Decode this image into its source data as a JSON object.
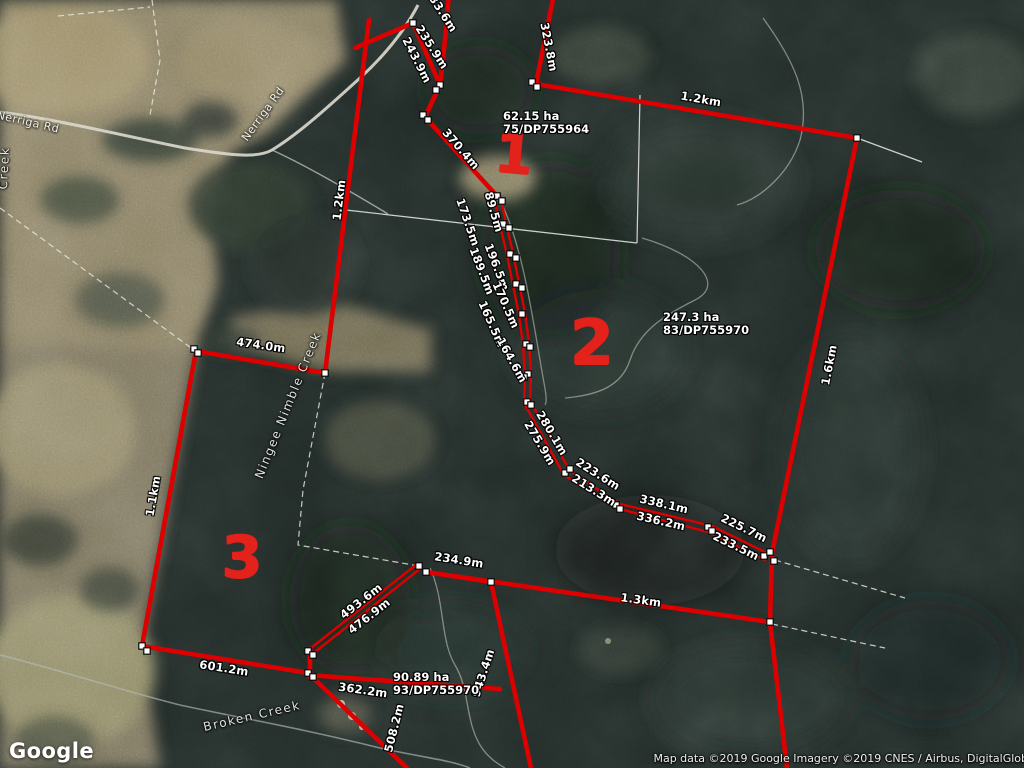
{
  "colors": {
    "boundary_red": "#dc0000",
    "marker_red": "#e3221c",
    "vertex_fill": "#ffffff",
    "vertex_stroke": "#0b0b0b"
  },
  "map": {
    "logo": "Google",
    "attribution": "Map data ©2019 Google  Imagery ©2019 CNES / Airbus, DigitalGlob",
    "measurements": [
      {
        "text": "233.6m",
        "x": 441,
        "y": 10,
        "rot": 57
      },
      {
        "text": "235.9m",
        "x": 432,
        "y": 47,
        "rot": 57
      },
      {
        "text": "243.9m",
        "x": 417,
        "y": 60,
        "rot": 63
      },
      {
        "text": "370.4m",
        "x": 461,
        "y": 149,
        "rot": 49
      },
      {
        "text": "323.8m",
        "x": 549,
        "y": 47,
        "rot": 79
      },
      {
        "text": "1.2km",
        "x": 701,
        "y": 99,
        "rot": 10
      },
      {
        "text": "1.6km",
        "x": 829,
        "y": 365,
        "rot": -79
      },
      {
        "text": "1.2km",
        "x": 339,
        "y": 200,
        "rot": -83
      },
      {
        "text": "173.5m",
        "x": 468,
        "y": 222,
        "rot": 71
      },
      {
        "text": "89.5m",
        "x": 494,
        "y": 212,
        "rot": 74
      },
      {
        "text": "196.5m",
        "x": 497,
        "y": 267,
        "rot": 69
      },
      {
        "text": "189.5m",
        "x": 482,
        "y": 271,
        "rot": 69
      },
      {
        "text": "170.5m",
        "x": 506,
        "y": 305,
        "rot": 66
      },
      {
        "text": "165.5m",
        "x": 492,
        "y": 324,
        "rot": 66
      },
      {
        "text": "164.6m",
        "x": 512,
        "y": 360,
        "rot": 61
      },
      {
        "text": "280.1m",
        "x": 552,
        "y": 433,
        "rot": 59
      },
      {
        "text": "275.9m",
        "x": 540,
        "y": 443,
        "rot": 59
      },
      {
        "text": "223.6m",
        "x": 598,
        "y": 474,
        "rot": 32
      },
      {
        "text": "213.3m",
        "x": 594,
        "y": 490,
        "rot": 32
      },
      {
        "text": "338.1m",
        "x": 664,
        "y": 504,
        "rot": 13
      },
      {
        "text": "336.2m",
        "x": 661,
        "y": 521,
        "rot": 13
      },
      {
        "text": "225.7m",
        "x": 744,
        "y": 528,
        "rot": 26
      },
      {
        "text": "233.5m",
        "x": 736,
        "y": 546,
        "rot": 26
      },
      {
        "text": "474.0m",
        "x": 261,
        "y": 345,
        "rot": 8
      },
      {
        "text": "1.1km",
        "x": 153,
        "y": 496,
        "rot": -80
      },
      {
        "text": "234.9m",
        "x": 459,
        "y": 560,
        "rot": 9
      },
      {
        "text": "1.3km",
        "x": 641,
        "y": 600,
        "rot": 8
      },
      {
        "text": "493.6m",
        "x": 361,
        "y": 601,
        "rot": -38
      },
      {
        "text": "476.9m",
        "x": 369,
        "y": 616,
        "rot": -38
      },
      {
        "text": "601.2m",
        "x": 224,
        "y": 668,
        "rot": 9
      },
      {
        "text": "362.2m",
        "x": 363,
        "y": 690,
        "rot": 8
      },
      {
        "text": "508.2m",
        "x": 394,
        "y": 728,
        "rot": -76
      },
      {
        "text": "943.4m",
        "x": 483,
        "y": 673,
        "rot": -72
      }
    ],
    "parcel_labels": [
      {
        "area": "62.15 ha",
        "lot": "75/DP755964",
        "x": 503,
        "y": 110
      },
      {
        "area": "247.3 ha",
        "lot": "83/DP755970",
        "x": 663,
        "y": 311
      },
      {
        "area": "90.89 ha",
        "lot": "93/DP755970",
        "x": 393,
        "y": 671
      }
    ],
    "parcel_numbers": [
      {
        "text": "1",
        "x": 514,
        "y": 155,
        "size": 54,
        "rot": 5
      },
      {
        "text": "2",
        "x": 592,
        "y": 343,
        "size": 62,
        "rot": 0
      },
      {
        "text": "3",
        "x": 242,
        "y": 557,
        "size": 58,
        "rot": 0
      }
    ],
    "road_labels": [
      {
        "text": "Nerriga Rd",
        "x": 28,
        "y": 122,
        "rot": 13
      },
      {
        "text": "Nerriga Rd",
        "x": 263,
        "y": 114,
        "rot": -54
      }
    ],
    "creek_labels": [
      {
        "text": "Ningee Nimble Creek",
        "x": 288,
        "y": 405,
        "rot": -68
      },
      {
        "text": "Broken Creek",
        "x": 252,
        "y": 716,
        "rot": -13
      },
      {
        "text": "Creek",
        "x": 4,
        "y": 168,
        "rot": -87
      }
    ]
  }
}
